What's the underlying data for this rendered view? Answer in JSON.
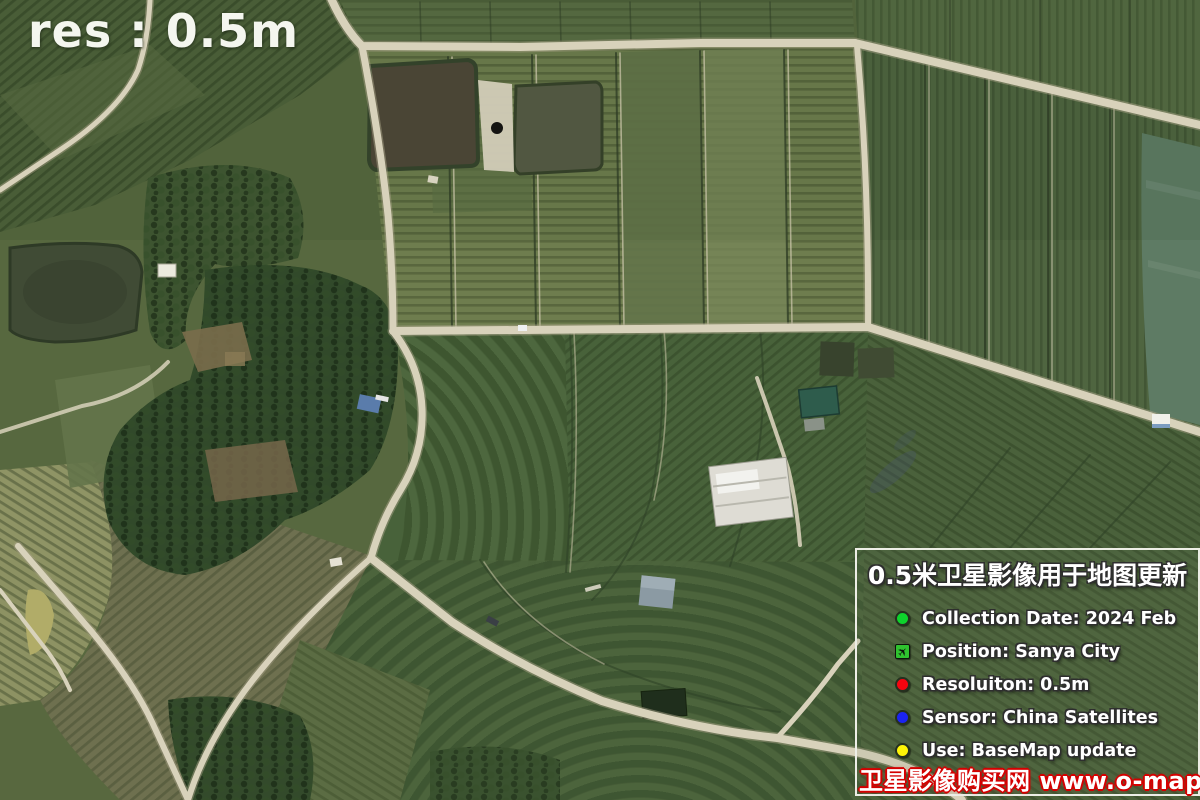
{
  "overlay": {
    "resolution_label": "res : 0.5m"
  },
  "info_panel": {
    "title": "0.5米卫星影像用于地图更新",
    "items": [
      {
        "label": "Collection Date: 2024 Feb",
        "color": "#0ed32c",
        "icon": "green-dot"
      },
      {
        "label": "Position: Sanya City",
        "color": "#2fc32f",
        "icon": "plane-square",
        "glyph": "✈"
      },
      {
        "label": "Resoluiton: 0.5m",
        "color": "#f6040f",
        "icon": "red-dot"
      },
      {
        "label": "Sensor: China Satellites",
        "color": "#1b23f2",
        "icon": "blue-dot"
      },
      {
        "label": "Use: BaseMap update",
        "color": "#fdf407",
        "icon": "yellow-dot"
      }
    ],
    "watermark": "卫星影像购买网 www.o-map.cn",
    "border_color": "#edeee6",
    "watermark_outline_color": "#d40000"
  }
}
